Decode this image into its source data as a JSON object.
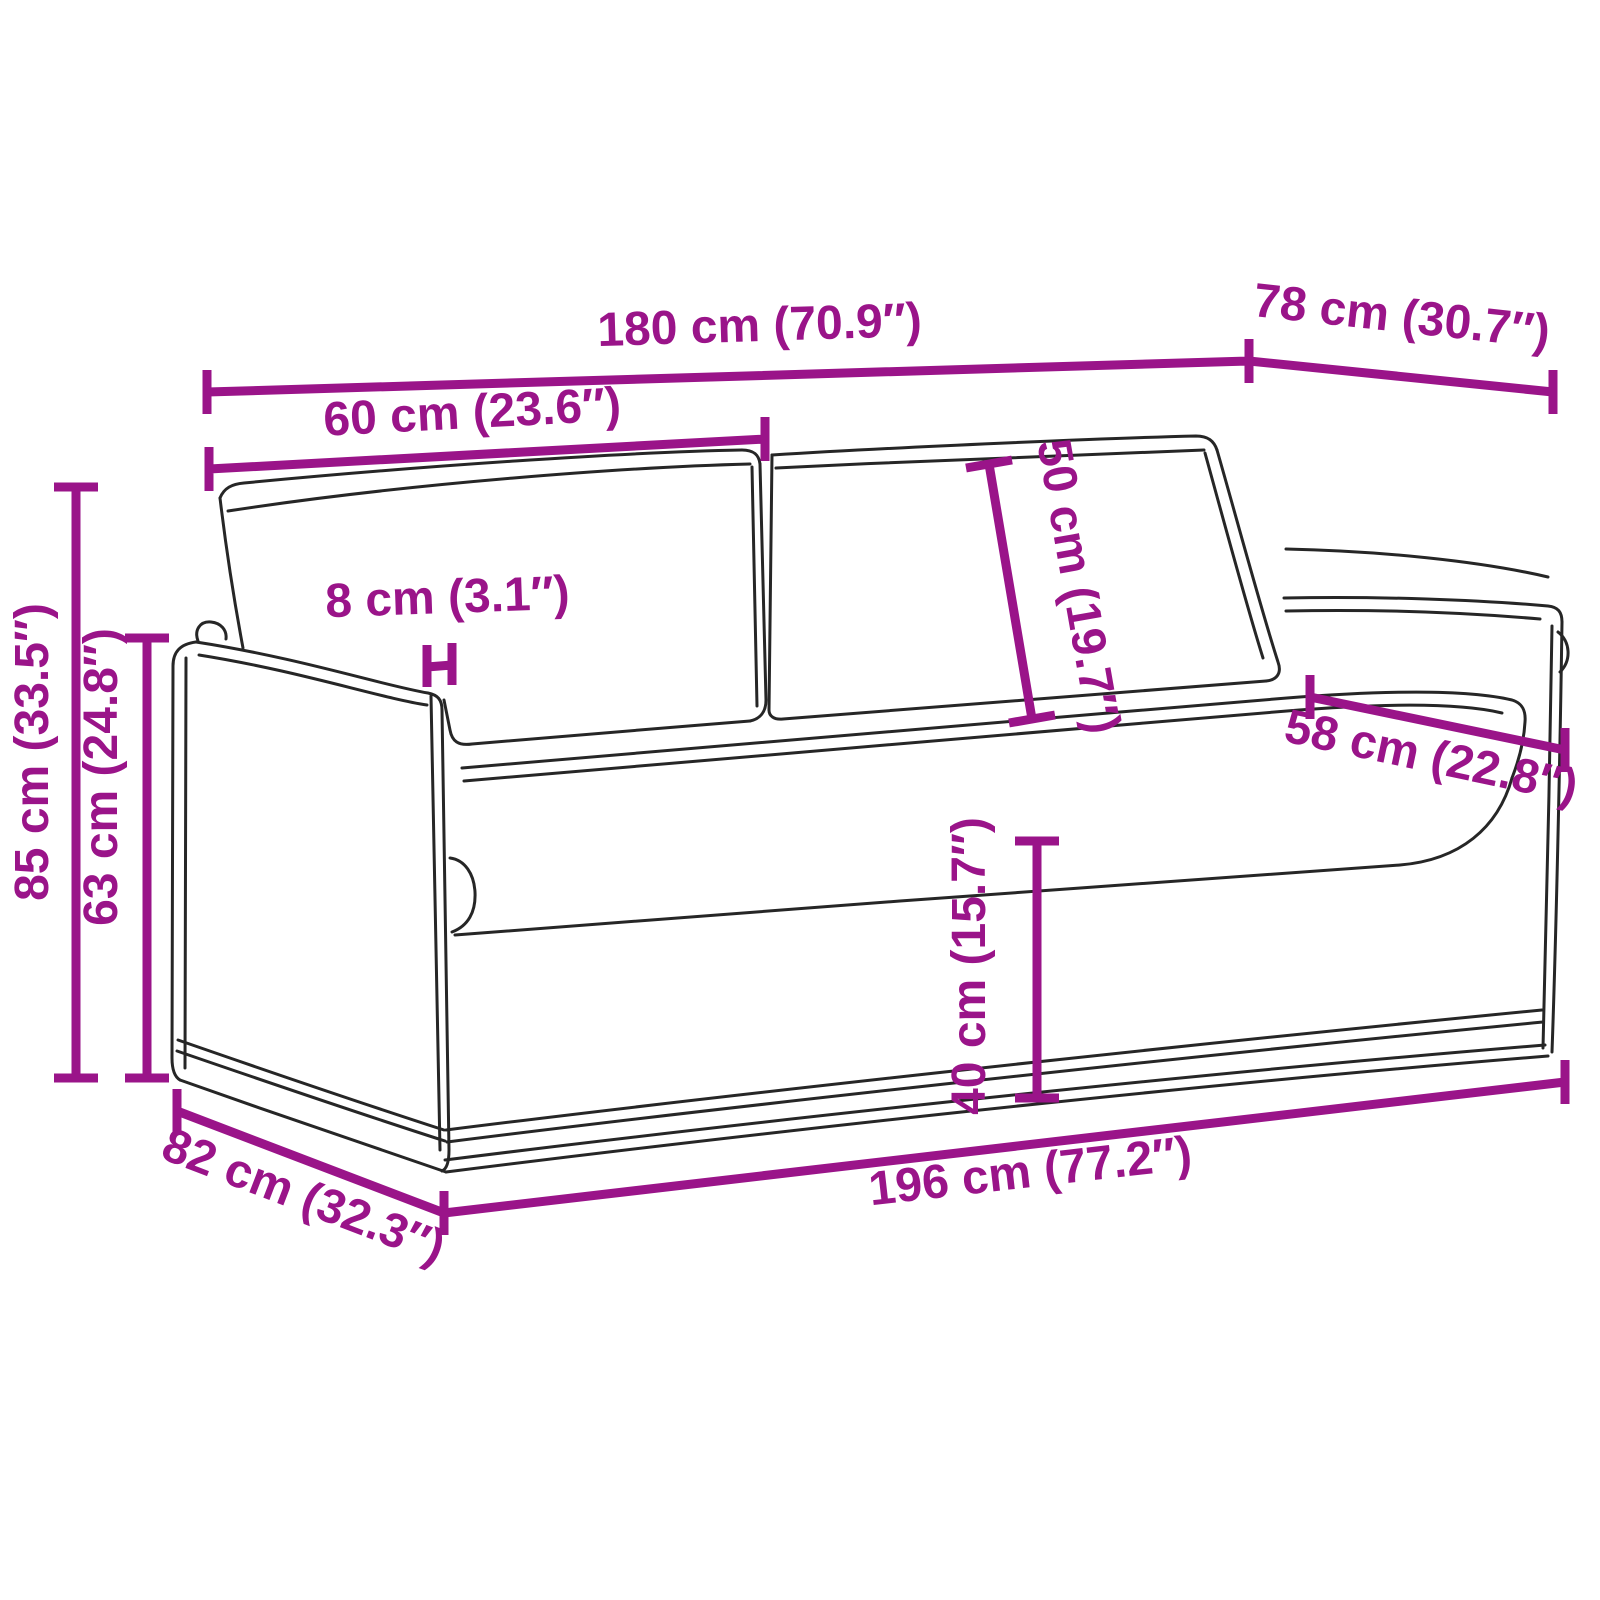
{
  "diagram": {
    "kind": "product-dimension-diagram",
    "subject": "sofa-line-drawing",
    "background_color": "#ffffff",
    "accent_color": "#9A1489",
    "outline_color": "#262626",
    "dimensions": {
      "total_width": "180 cm (70.9″)",
      "top_depth": "78 cm (30.7″)",
      "back_cushion_width": "60 cm (23.6″)",
      "back_cushion_height": "50 cm (19.7″)",
      "armrest_thickness": "8 cm (3.1″)",
      "total_height": "85 cm (33.5″)",
      "armrest_height": "63 cm (24.8″)",
      "seat_depth": "58 cm (22.8″)",
      "seat_height": "40 cm (15.7″)",
      "base_depth": "82 cm (32.3″)",
      "base_width": "196 cm (77.2″)"
    }
  }
}
